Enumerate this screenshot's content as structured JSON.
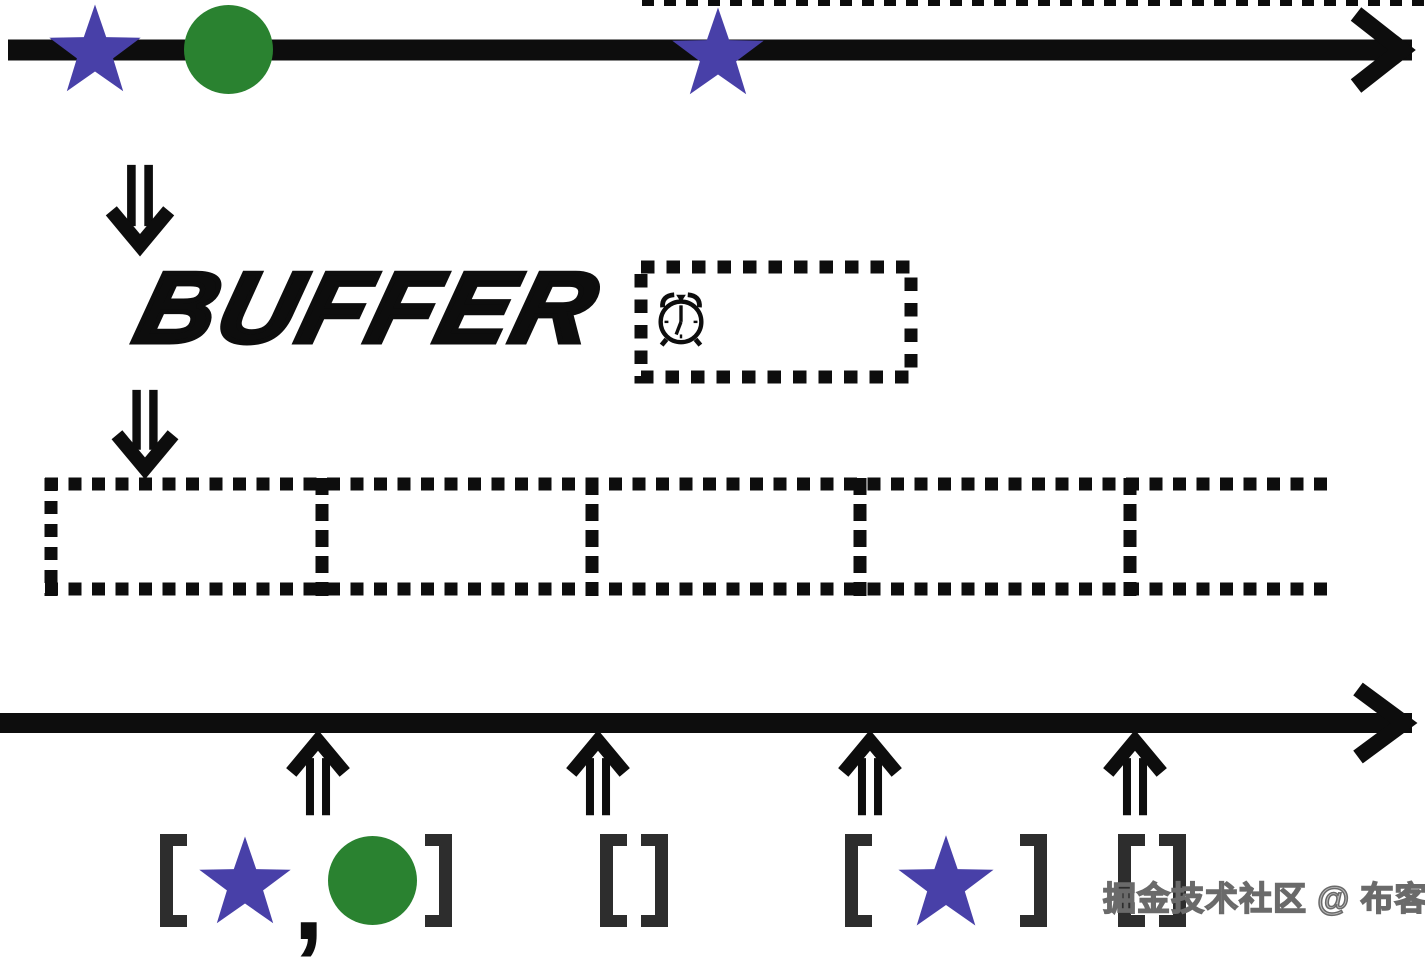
{
  "page": {
    "background": "#ffffff",
    "width": 1425,
    "height": 929
  },
  "labels": {
    "operator": "BUFFER",
    "comma": ","
  },
  "watermark": {
    "text": "掘金技术社区 @ 布客飞龙"
  },
  "colors": {
    "ink": "#0d0d0d",
    "star": "#4840a8",
    "circle": "#2a8230",
    "bracket": "#2d2d2d",
    "watermark_fill": "#bdbdbd",
    "watermark_outline": "#6a6a6a"
  },
  "source_stream": {
    "description": "input observable timeline with marble events",
    "events": [
      {
        "shape": "star",
        "x": 95
      },
      {
        "shape": "circle",
        "x": 228
      },
      {
        "shape": "star",
        "x": 718
      }
    ]
  },
  "operator": {
    "name": "BUFFER",
    "trigger_icon": "alarm-clock",
    "window": "timer"
  },
  "buffer_strip": {
    "cell_boundaries_x": [
      51,
      322,
      592,
      860,
      1130
    ],
    "right_open_end_x": 1337
  },
  "output_stream": {
    "emissions": [
      {
        "x": 318,
        "items": [
          "star",
          "circle"
        ]
      },
      {
        "x": 598,
        "items": []
      },
      {
        "x": 870,
        "items": [
          "star"
        ]
      },
      {
        "x": 1135,
        "items": []
      }
    ]
  }
}
